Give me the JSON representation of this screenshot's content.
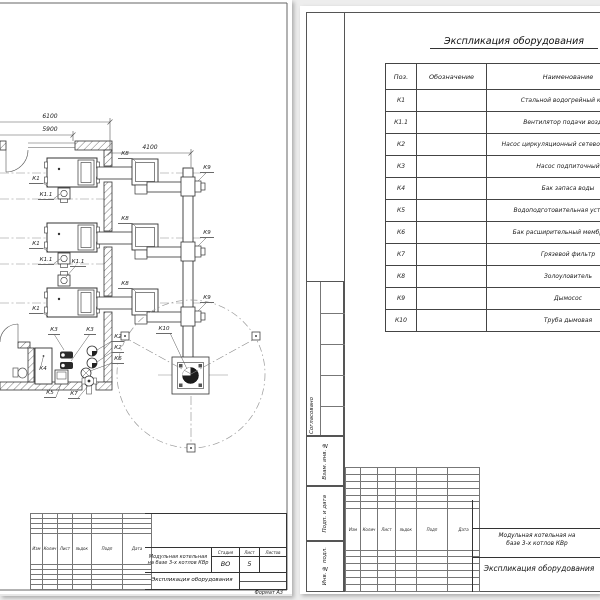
{
  "palette": {
    "page_bg": "#ededed",
    "paper": "#ffffff",
    "line": "#3a3a3a",
    "centerline": "#8a8a8a",
    "fill_dark": "#222222"
  },
  "plan_sheet": {
    "dims": {
      "overall": "6100",
      "inner": "5900",
      "flue": "4100"
    },
    "labels": {
      "k1": "К1",
      "k11": "К1.1",
      "k2": "К2",
      "k3": "К3",
      "k4": "К4",
      "k5": "К5",
      "k6": "К6",
      "k7": "К7",
      "k8": "К8",
      "k9": "К9",
      "k10": "К10"
    },
    "title_block": {
      "rev_cols": [
        "Изм",
        "Колич",
        "Лист",
        "№док",
        "Подп",
        "Дата"
      ],
      "project": "Модульная котельная на базе 3-х котлов КВр",
      "doc_name": "Экспликация оборудования",
      "stage_label": "Стадия",
      "sheet_label": "Лист",
      "sheets_label": "Листов",
      "stage": "ВО",
      "sheet": "5",
      "sheets": "",
      "format": "Формат  А3"
    }
  },
  "spec_sheet": {
    "title": "Экспликация оборудования",
    "table": {
      "headers": [
        "Поз.",
        "Обозначение",
        "Наименование"
      ],
      "rows": [
        {
          "pos": "К1",
          "designation": "",
          "name": "Стальной водогрейный котел"
        },
        {
          "pos": "К1.1",
          "designation": "",
          "name": "Вентилятор подачи воздуха"
        },
        {
          "pos": "К2",
          "designation": "",
          "name": "Насос циркуляционный сетевого контура"
        },
        {
          "pos": "К3",
          "designation": "",
          "name": "Насос подпиточный"
        },
        {
          "pos": "К4",
          "designation": "",
          "name": "Бак запаса воды"
        },
        {
          "pos": "К5",
          "designation": "",
          "name": "Водоподготовительная установка"
        },
        {
          "pos": "К6",
          "designation": "",
          "name": "Бак расширительный мембранный"
        },
        {
          "pos": "К7",
          "designation": "",
          "name": "Грязевой фильтр"
        },
        {
          "pos": "К8",
          "designation": "",
          "name": "Золоуловитель"
        },
        {
          "pos": "К9",
          "designation": "",
          "name": "Дымосос"
        },
        {
          "pos": "К10",
          "designation": "",
          "name": "Труба дымовая"
        }
      ]
    },
    "margin_labels": {
      "agreed": "Согласовано",
      "vzam": "Взам. инв. №",
      "podp": "Подп. и дата",
      "inv": "Инв. № подл."
    },
    "title_block": {
      "rev_cols": [
        "Изм",
        "Колич",
        "Лист",
        "№док",
        "Подп",
        "Дата"
      ],
      "project_l1": "Модульная котельная на",
      "project_l2": "базе 3-х котлов КВр",
      "doc_name": "Экспликация оборудования"
    }
  }
}
